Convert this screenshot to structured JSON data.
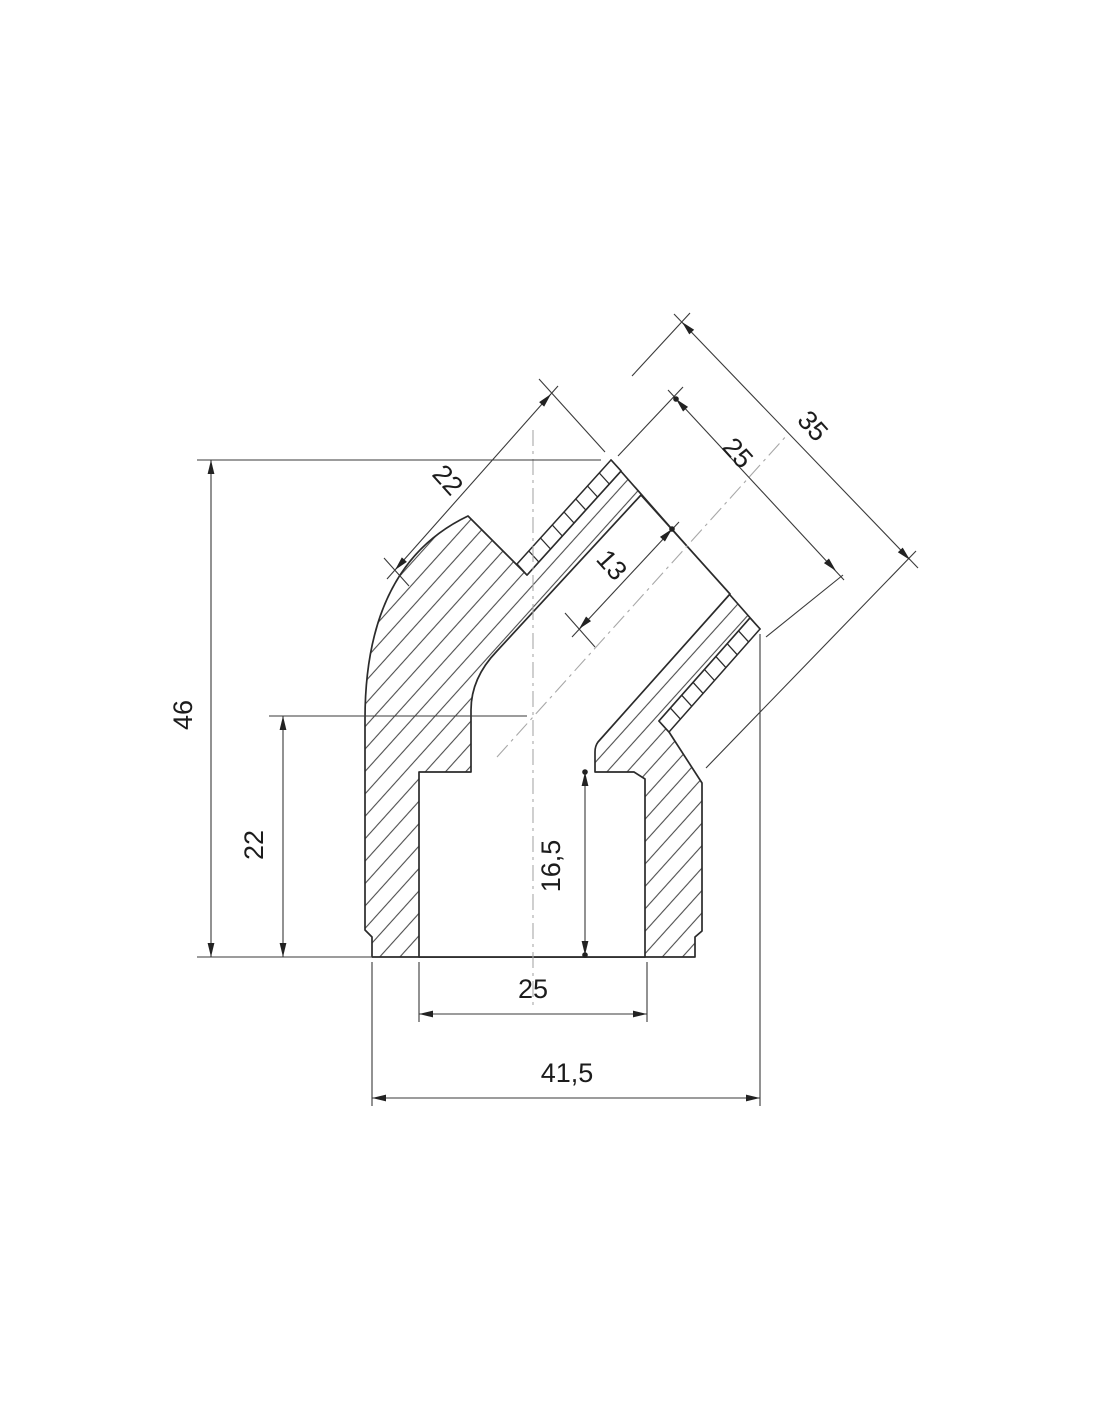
{
  "drawing": {
    "background": "#ffffff",
    "line_color": "#2b2b2b",
    "dim_color": "#3a3a3a",
    "centerline_color": "#a8a8a8",
    "dim_labels": {
      "overall_height": "46",
      "socket_height": "22",
      "socket_depth": "16,5",
      "socket_inner_width": "25",
      "overall_width": "41,5",
      "branch_width": "22",
      "branch_thread_length": "13",
      "branch_length": "25",
      "branch_overall_length": "35"
    }
  }
}
